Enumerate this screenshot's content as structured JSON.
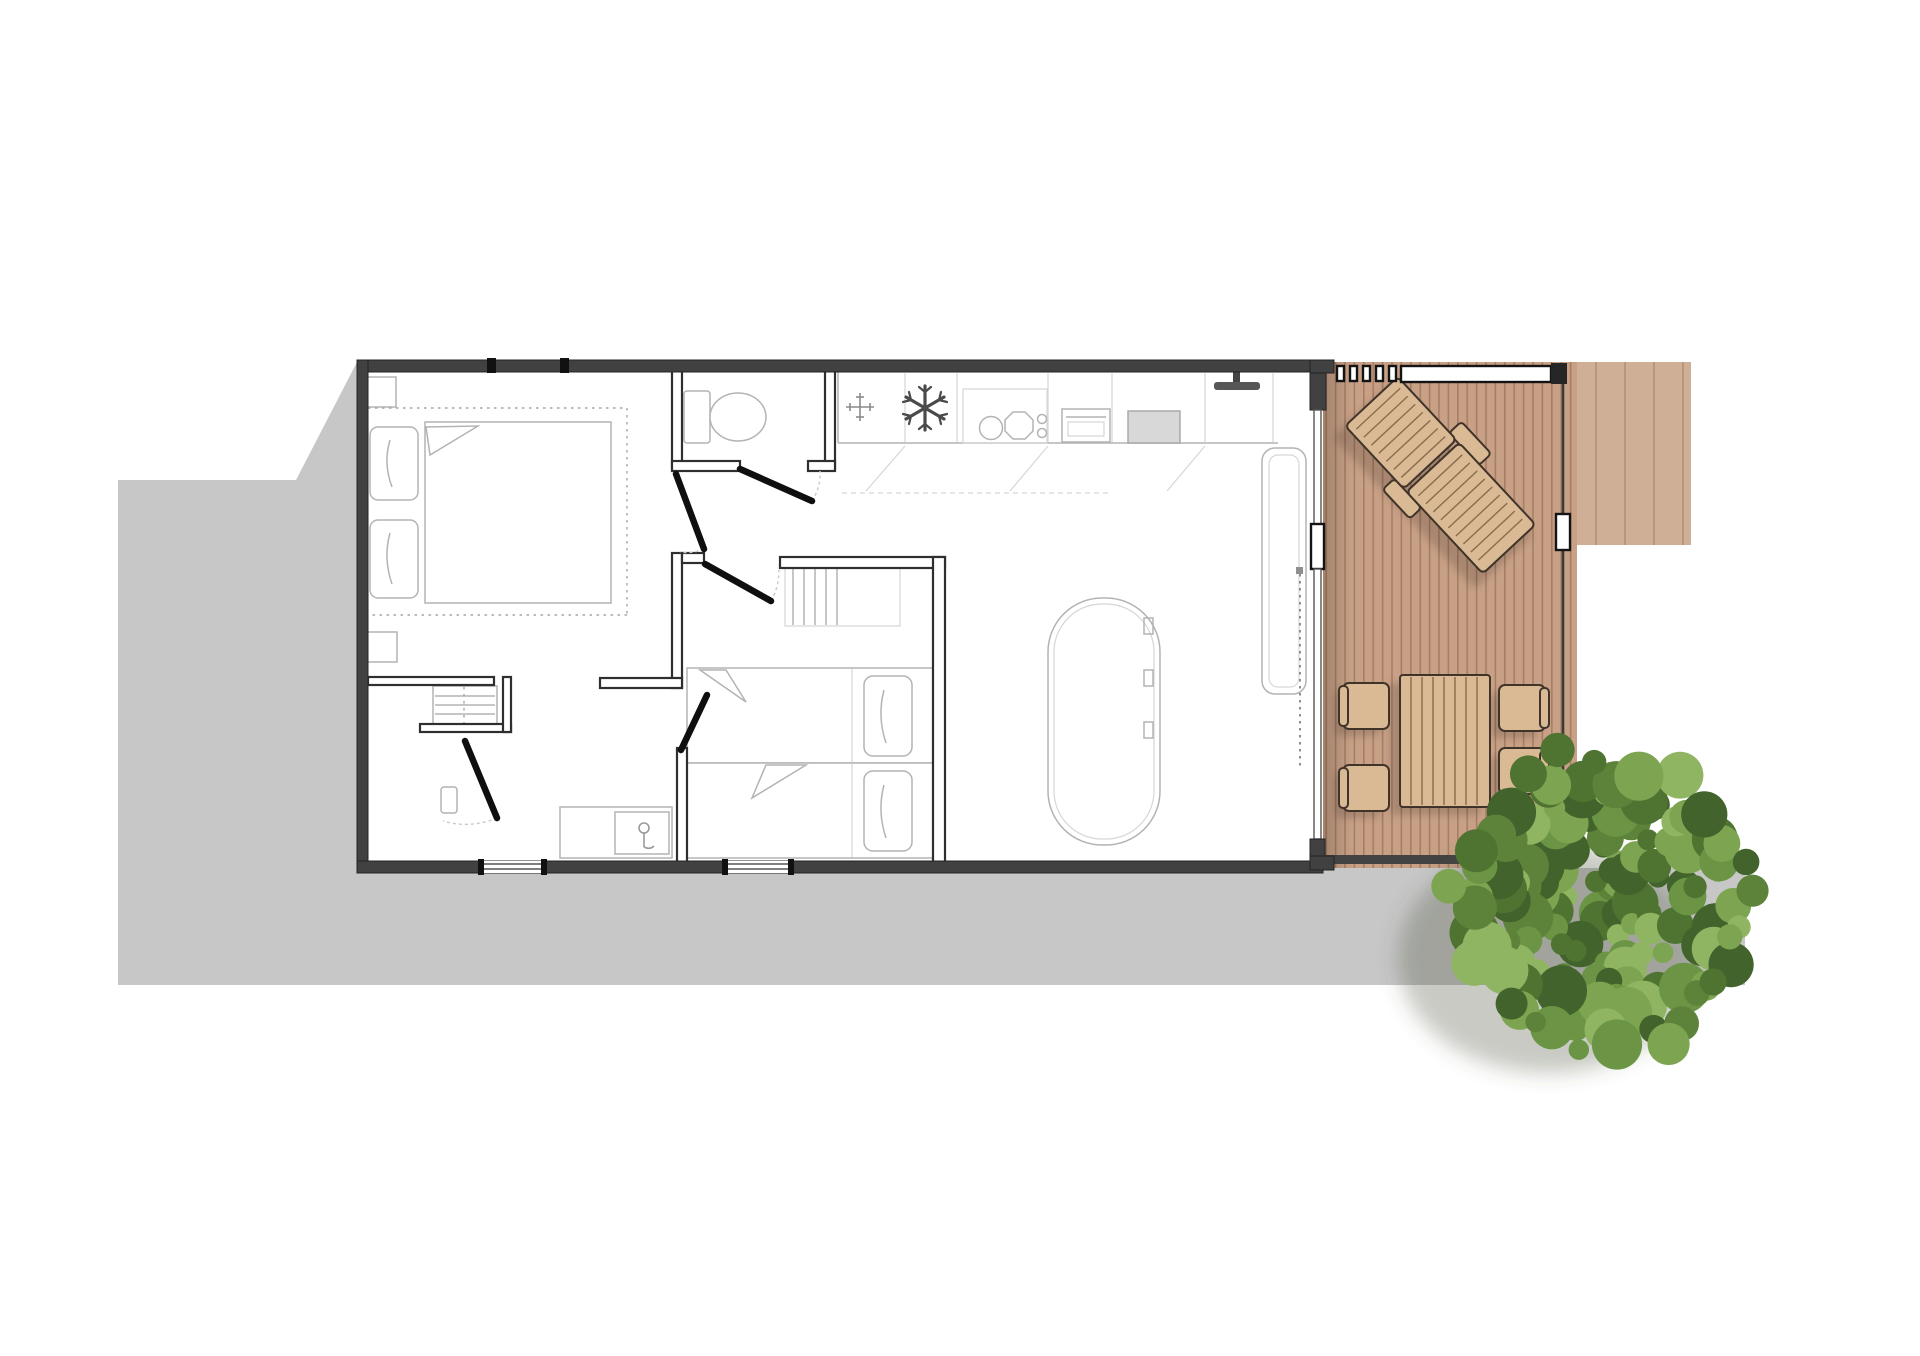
{
  "document": {
    "title": "Mobile home floor plan",
    "type": "architectural-floor-plan",
    "view": "top-down",
    "visible_text": ""
  },
  "colors": {
    "page_bg": "#ffffff",
    "ground_shadow": "#c7c7c8",
    "wall": "#414141",
    "wall_edge": "#242424",
    "wall_interior": "#2f2f2f",
    "furniture_line": "#b3b3b3",
    "furniture_line_light": "#d6d6d6",
    "door": "#0f0f0f",
    "swing_arc": "#c9c9c9",
    "glazing_line": "#555555",
    "railing_dark": "#262626",
    "deck_base": "#c8a086",
    "deck_ext_base": "#cfb097",
    "deck_plank_line": "#7a5538",
    "deck_furniture_fill": "#d9ba94",
    "deck_furniture_stroke": "#40342a",
    "deck_slat_line": "#8a6b4c",
    "tree_shadow": "rgba(70,78,58,0.30)"
  },
  "tree": {
    "palette": [
      "#42632c",
      "#4f7431",
      "#5c8339",
      "#6b9544",
      "#7da551",
      "#90b562"
    ],
    "center_x": 1601,
    "center_y": 903,
    "radius": 150,
    "blobs": 140
  },
  "inventory": {
    "areas": [
      "master-bedroom",
      "wc",
      "kitchen",
      "living-dining",
      "hallway",
      "bathroom",
      "second-bedroom",
      "deck-terrace",
      "side-terrace",
      "garden"
    ],
    "fixtures": [
      "double-bed",
      "nightstands",
      "wardrobe-shelves",
      "toilet",
      "shower",
      "washbasin",
      "kitchen-sink",
      "fridge",
      "oven",
      "microwave",
      "tv",
      "dining-table",
      "bench-sofa",
      "twin-beds",
      "closet-rail"
    ],
    "deck_furniture": [
      "sun-lounger",
      "outdoor-table",
      "outdoor-chairs"
    ],
    "outdoor_chair_count": 4,
    "railing_post_count": 5,
    "tree_count": 1
  }
}
